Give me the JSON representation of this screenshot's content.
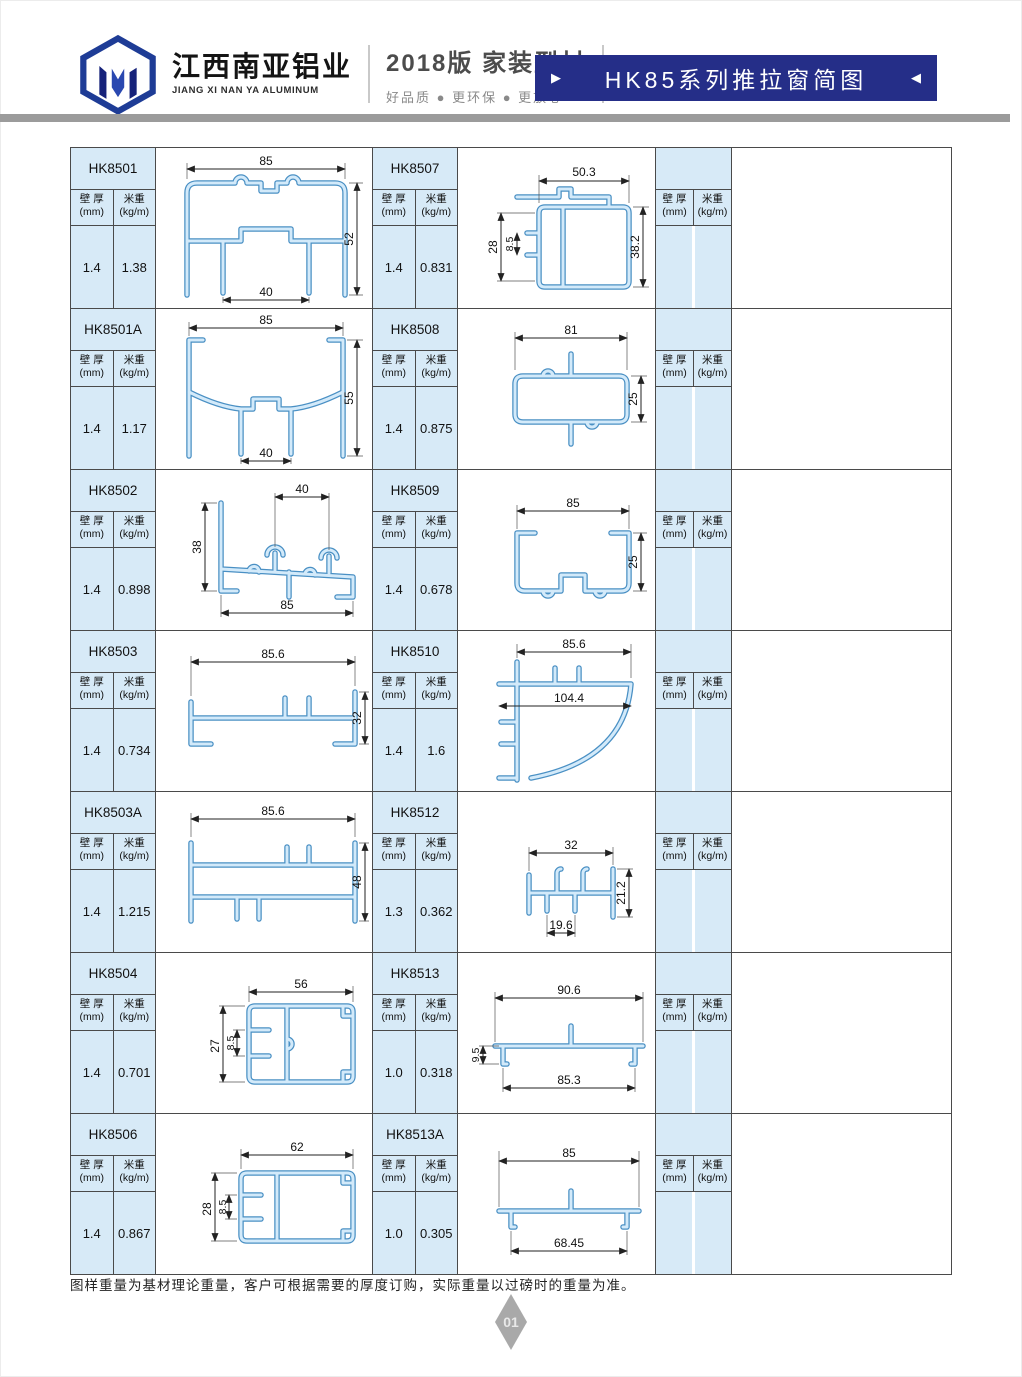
{
  "colors": {
    "banner": "#252e88",
    "cell_blue": "#d7eaf7",
    "profile_stroke": "#4a90c4",
    "bar_gray": "#9b9b9b"
  },
  "header": {
    "company_cn": "江西南亚铝业",
    "company_en": "JIANG XI NAN YA ALUMINUM",
    "edition": "2018版  家装型材",
    "slogan": "好品质 ● 更环保 ● 更放心",
    "banner_title": "HK85系列推拉窗简图",
    "arrow_right": "▶",
    "arrow_left": "◀"
  },
  "col": {
    "wall_cn": "壁 厚",
    "wall_unit": "(mm)",
    "weight_cn": "米重",
    "weight_unit": "(kg/m)"
  },
  "table": {
    "rows": [
      {
        "left": {
          "code": "HK8501",
          "wall": "1.4",
          "weight": "1.38",
          "dims": {
            "d1": "85",
            "d2": "52",
            "d3": "40"
          }
        },
        "right": {
          "code": "HK8507",
          "wall": "1.4",
          "weight": "0.831",
          "dims": {
            "d1": "50.3",
            "d2": "38.2",
            "d3": "28",
            "d4": "8.5"
          }
        }
      },
      {
        "left": {
          "code": "HK8501A",
          "wall": "1.4",
          "weight": "1.17",
          "dims": {
            "d1": "85",
            "d2": "55",
            "d3": "40"
          }
        },
        "right": {
          "code": "HK8508",
          "wall": "1.4",
          "weight": "0.875",
          "dims": {
            "d1": "81",
            "d2": "25"
          }
        }
      },
      {
        "left": {
          "code": "HK8502",
          "wall": "1.4",
          "weight": "0.898",
          "dims": {
            "d1": "40",
            "d2": "38",
            "d3": "85"
          }
        },
        "right": {
          "code": "HK8509",
          "wall": "1.4",
          "weight": "0.678",
          "dims": {
            "d1": "85",
            "d2": "25"
          }
        }
      },
      {
        "left": {
          "code": "HK8503",
          "wall": "1.4",
          "weight": "0.734",
          "dims": {
            "d1": "85.6",
            "d2": "32"
          }
        },
        "right": {
          "code": "HK8510",
          "wall": "1.4",
          "weight": "1.6",
          "dims": {
            "d1": "85.6",
            "d2": "104.4"
          }
        }
      },
      {
        "left": {
          "code": "HK8503A",
          "wall": "1.4",
          "weight": "1.215",
          "dims": {
            "d1": "85.6",
            "d2": "48"
          }
        },
        "right": {
          "code": "HK8512",
          "wall": "1.3",
          "weight": "0.362",
          "dims": {
            "d1": "32",
            "d2": "21.2",
            "d3": "19.6"
          }
        }
      },
      {
        "left": {
          "code": "HK8504",
          "wall": "1.4",
          "weight": "0.701",
          "dims": {
            "d1": "56",
            "d2": "27",
            "d3": "8.5"
          }
        },
        "right": {
          "code": "HK8513",
          "wall": "1.0",
          "weight": "0.318",
          "dims": {
            "d1": "90.6",
            "d2": "9.5",
            "d3": "85.3"
          }
        }
      },
      {
        "left": {
          "code": "HK8506",
          "wall": "1.4",
          "weight": "0.867",
          "dims": {
            "d1": "62",
            "d2": "28",
            "d3": "8.5"
          }
        },
        "right": {
          "code": "HK8513A",
          "wall": "1.0",
          "weight": "0.305",
          "dims": {
            "d1": "85",
            "d2": "68.45"
          }
        }
      }
    ]
  },
  "footer": {
    "note": "图样重量为基材理论重量，客户可根据需要的厚度订购，实际重量以过磅时的重量为准。",
    "page": "01"
  }
}
